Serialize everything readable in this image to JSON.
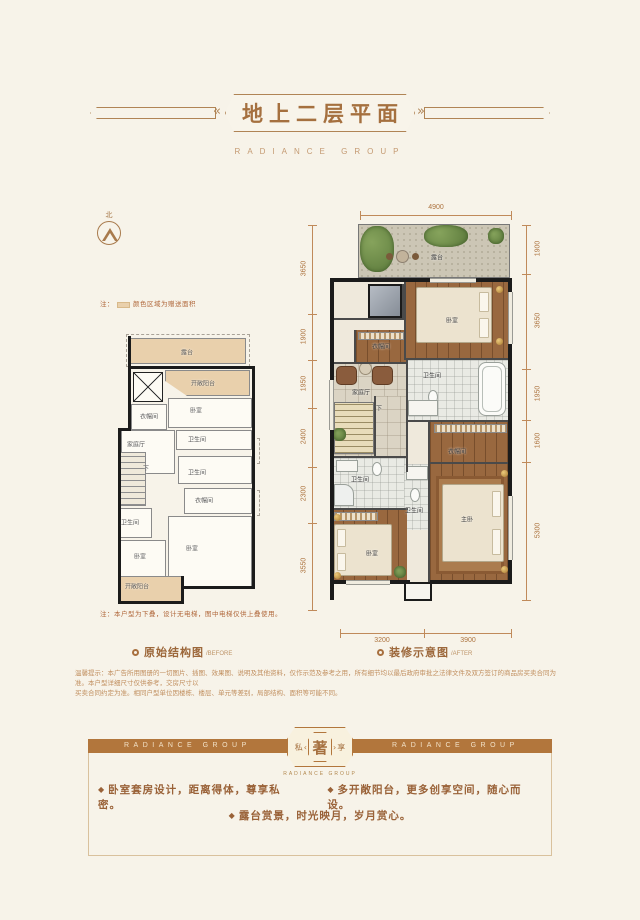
{
  "theme": {
    "bg": "#f7f3e9",
    "accent": "#a5703f",
    "ribbon": "#b2763c",
    "gift_area": "#e9d0ac",
    "dim_color": "#ad7440"
  },
  "header": {
    "title": "地上二层平面",
    "subtitle": "RADIANCE GROUP"
  },
  "compass": {
    "north": "北"
  },
  "legend_note": {
    "prefix": "注：",
    "text": "颜色区域为赠送面积"
  },
  "before_note": "注：本户型为下叠，设计无电梯，图中电梯仅供上叠使用。",
  "before_plan": {
    "rooms": [
      "露台",
      "开敞阳台",
      "卧室",
      "衣帽间",
      "卫生间",
      "家庭厅",
      "卫生间",
      "衣帽间",
      "卫生间",
      "卧室",
      "卧室",
      "开敞阳台"
    ],
    "stair": "下"
  },
  "after_plan": {
    "rooms": [
      "露台",
      "卧室",
      "衣帽间",
      "家庭厅",
      "卫生间",
      "卫生间",
      "衣帽间",
      "卫生间",
      "主卧",
      "卧室"
    ],
    "stair": "下",
    "dims": {
      "top": [
        "4900"
      ],
      "left": [
        "3650",
        "1900",
        "1950",
        "2400",
        "2300",
        "3550"
      ],
      "right": [
        "1900",
        "3650",
        "1950",
        "1600",
        "5300"
      ],
      "bottom": [
        "3200",
        "3900"
      ]
    }
  },
  "captions": {
    "before": {
      "label": "原始结构图",
      "en": "/BEFORE"
    },
    "after": {
      "label": "装修示意图",
      "en": "/AFTER"
    }
  },
  "disclaimer": {
    "line1": "温馨提示：本广告所用图册的一切图片、插图、效果图、说明及其他资料，仅作示范及参考之用，所有细节均以最后政府审批之法律文件及双方签订的商品房买卖合同为准。本户型详细尺寸仅供参考，交房尺寸以",
    "line2": "买卖合同约定为准。相同户型单位因楼栋、楼层、单元等差别，局部结构、面积等可能不同。"
  },
  "ribbon": {
    "left": "RADIANCE GROUP",
    "right": "RADIANCE GROUP",
    "badge": {
      "left": "私",
      "center": "著",
      "right": "享",
      "sub": "RADIANCE GROUP"
    }
  },
  "features": [
    "卧室套房设计，距离得体，尊享私密。",
    "多开敞阳台，更多创享空间，随心而设。",
    "露台赏景，时光映月，岁月赏心。"
  ]
}
